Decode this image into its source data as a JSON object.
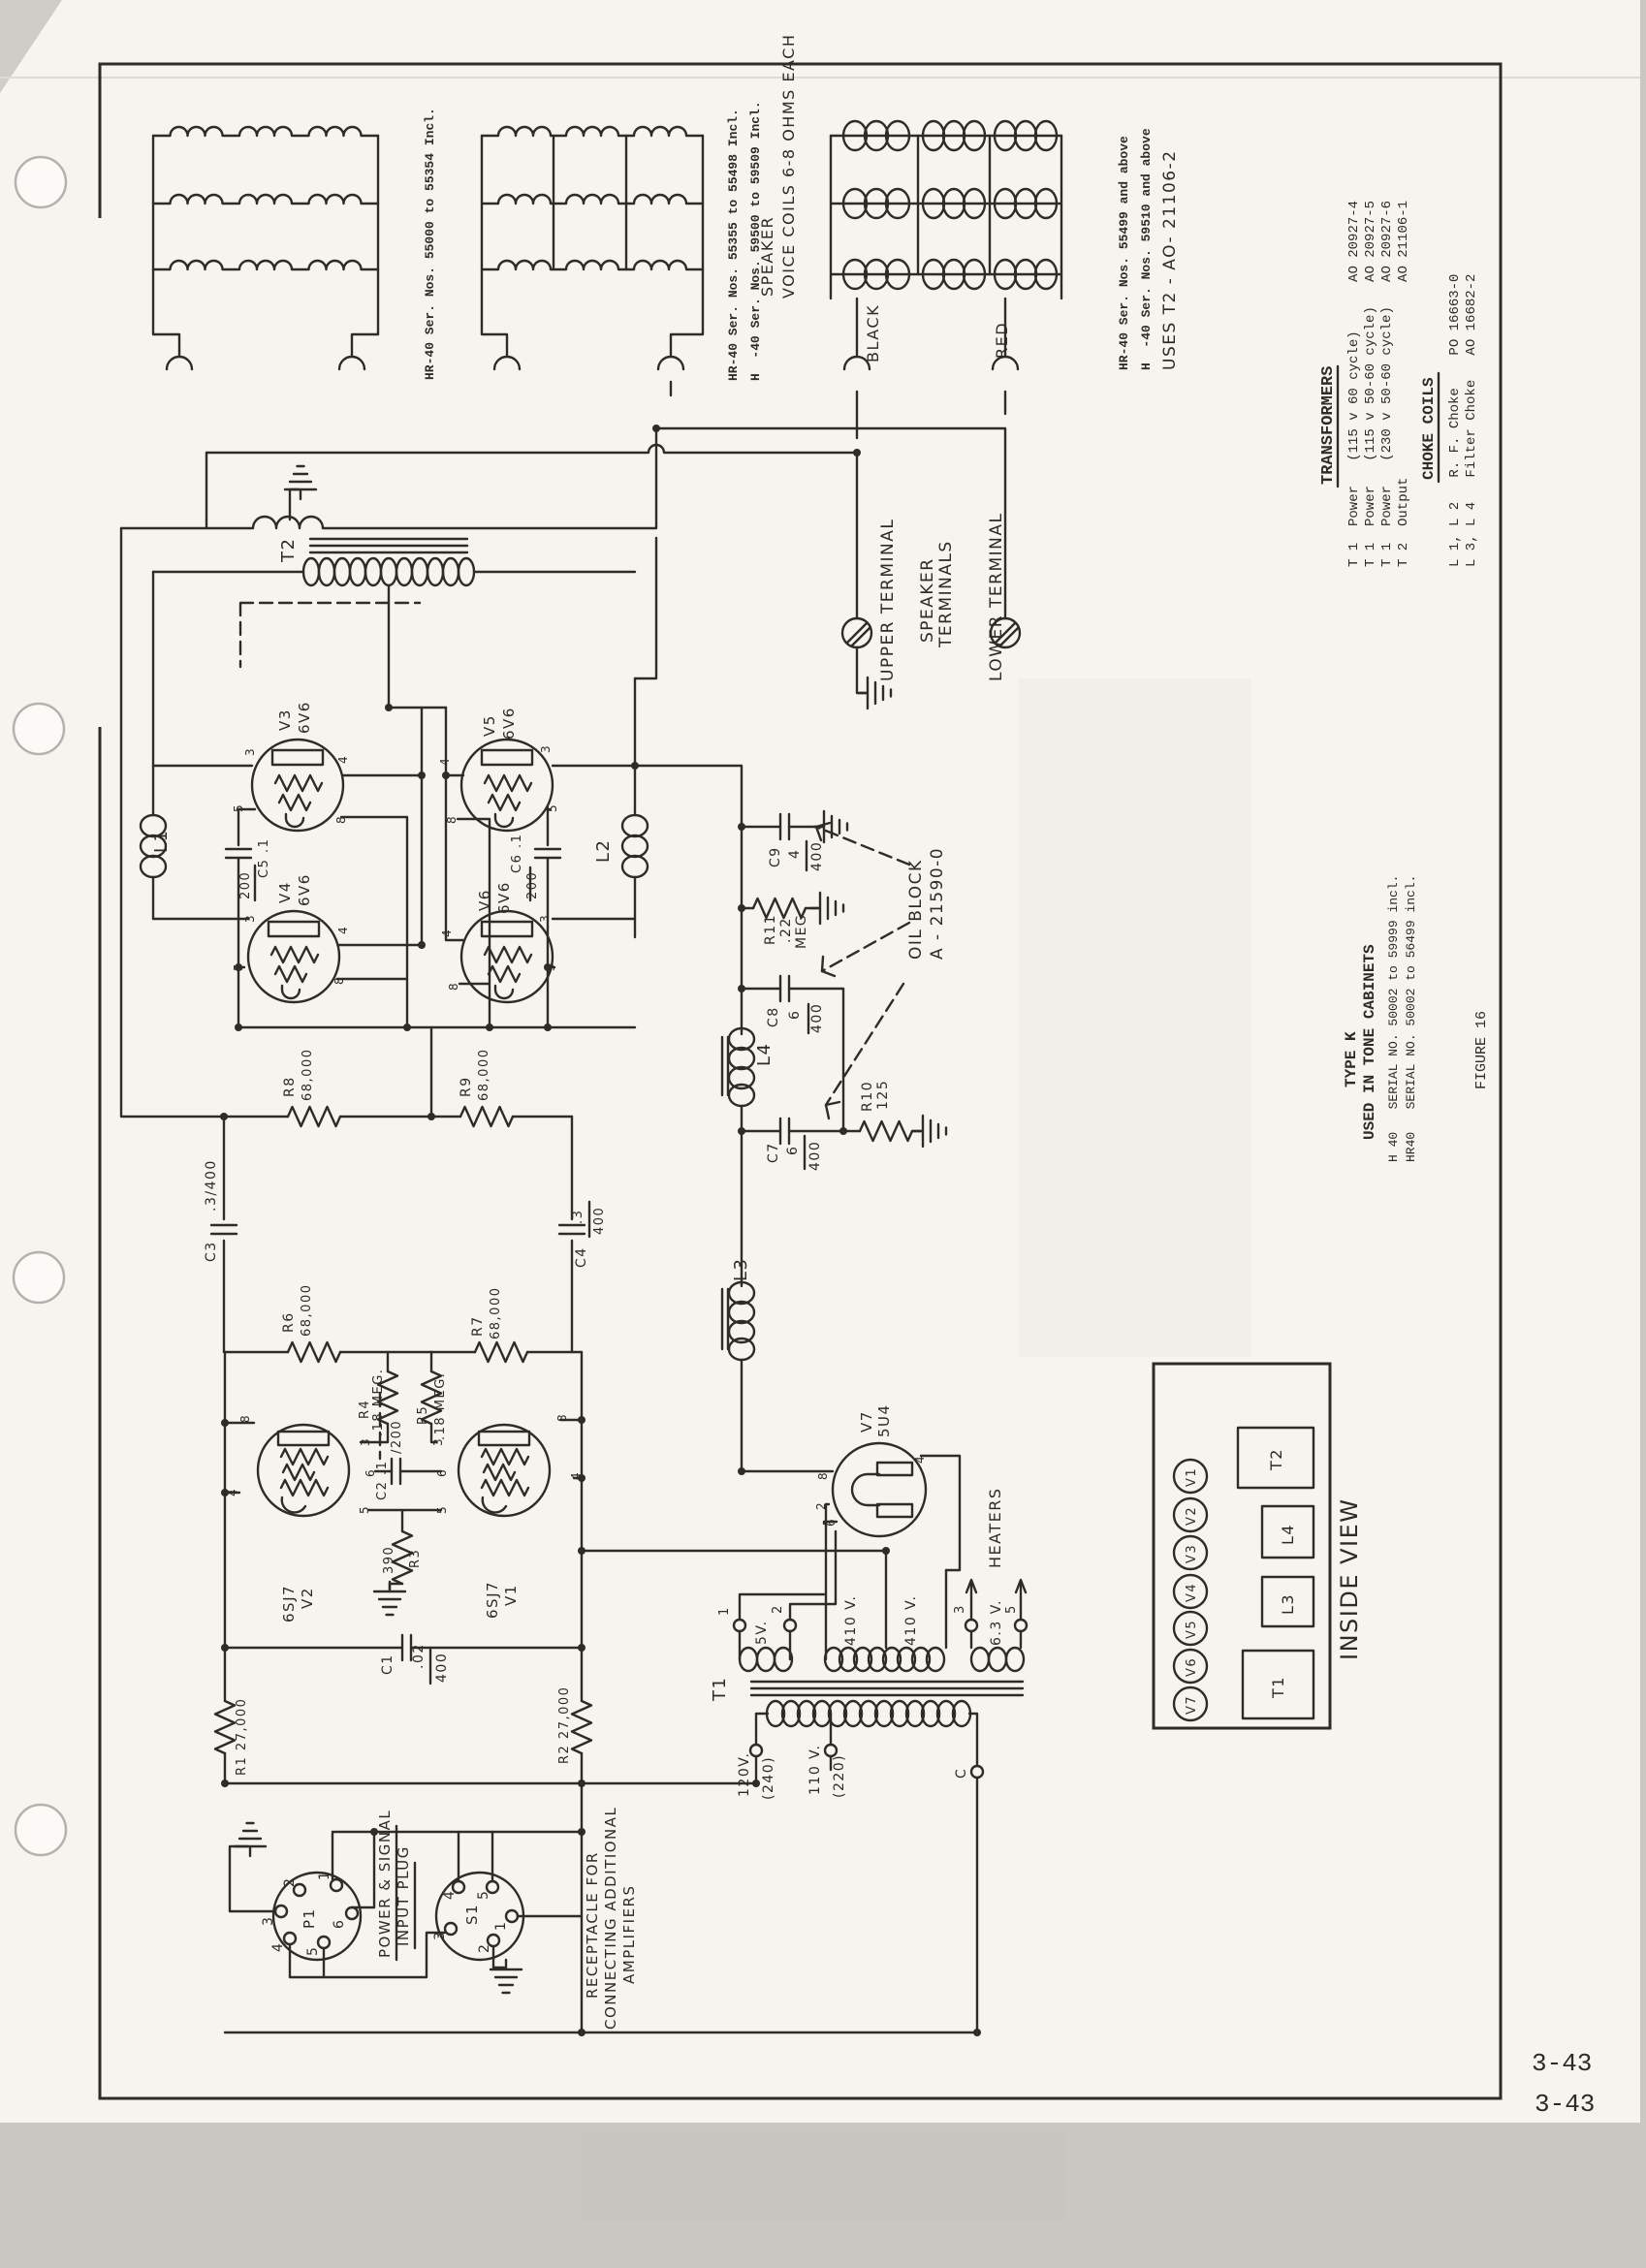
{
  "page": {
    "number": "3-43",
    "figure": "FIGURE 16"
  },
  "speaker_section": {
    "group1_caption": "HR-40 Ser. Nos. 55000 to 55354 Incl.",
    "group2_caption1": "HR-40 Ser. Nos. 55355 to 55498 Incl.",
    "group2_caption2": "H  -40 Ser. Nos. 59500 to 59509 Incl.",
    "speaker1": "SPEAKER",
    "speaker2": "VOICE COILS 6-8 OHMS EACH",
    "group3_caption1": "HR-40 Ser. Nos. 55499 and above",
    "group3_caption2": "H  -40 Ser. Nos. 59510 and above",
    "group3_caption3": "USES T2 - AO- 21106-2",
    "black": "BLACK",
    "red": "RED"
  },
  "terminals": {
    "upper": "UPPER TERMINAL",
    "spk1": "SPEAKER",
    "spk2": "TERMINALS",
    "lower": "LOWER TERMINAL"
  },
  "tables": {
    "transformers": {
      "title": "TRANSFORMERS",
      "rows": [
        "T 1  Power   (115 v 60 cycle)      AO 20927-4",
        "T 1  Power   (115 v 50-60 cycle)   AO 20927-5",
        "T 1  Power   (230 v 50-60 cycle)   AO 20927-6",
        "T 2  Output                        AO 21106-1"
      ]
    },
    "choke_coils": {
      "title": "CHOKE COILS",
      "rows": [
        "L 1, L 2   R. F. Choke    PO 16663-0",
        "L 3, L 4   Filter Choke   AO 16682-2"
      ]
    }
  },
  "type_block": {
    "line1": "TYPE K",
    "line2": "USED IN TONE CABINETS",
    "line3": "H 40   SERIAL NO. 50002 to 59999 incl.",
    "line4": "HR40   SERIAL NO. 50002 to 56499 incl."
  },
  "inside_view": {
    "title": "INSIDE VIEW",
    "tubes": [
      "V1",
      "V2",
      "V3",
      "V4",
      "V5",
      "V6",
      "V7"
    ],
    "blocks": [
      "T2",
      "L4",
      "L3",
      "T1"
    ]
  },
  "labels": {
    "t2": "T2",
    "t1": "T1",
    "l1": "L1",
    "l2": "L2",
    "l3": "L3",
    "l4": "L4",
    "v1": "V1",
    "v2": "V2",
    "v3": "V3",
    "v4": "V4",
    "v5": "V5",
    "v6": "V6",
    "v7": "V7",
    "type6v6": "6V6",
    "type6sj7": "6SJ7",
    "type5u4": "5U4",
    "r1": "R1 27,000",
    "r2": "R2 27,000",
    "r3": "R3",
    "r3v": "390",
    "r4": "R4",
    "r5": "R5",
    "meg18": ".18 MEG.",
    "r6": "R6",
    "r7": "R7",
    "r8": "R8",
    "r9": "R9",
    "k68": "68,000",
    "r10": "R10",
    "r10v": "125",
    "r11": "R11",
    "r11n": ".22",
    "r11d": "MEG.",
    "c1": "C1",
    "c1n": ".02",
    "c1d": "400",
    "c2": "C2 .1",
    "c2d": "/200",
    "c3": "C3",
    "c3v": ".3/400",
    "c4": "C4",
    "c4n": ".3",
    "c4d": "400",
    "c5": "C5 .1",
    "c5d": "200",
    "c6": "C6 .1",
    "c6d": "200",
    "c7": "C7",
    "c7n": "6",
    "c7d": "400",
    "c8": "C8",
    "c8n": "6",
    "c8d": "400",
    "c9": "C9",
    "c9n": "4",
    "c9d": "400",
    "oil1": "OIL BLOCK",
    "oil2": "A - 21590-0",
    "heaters": "HEATERS",
    "n1": "1",
    "n2": "2",
    "n3": "3",
    "n5": "5",
    "v5v": "5V.",
    "v410": "410 V.",
    "v63": "6.3 V.",
    "v120": "120V.",
    "v240": "(240)",
    "v110": "110 V.",
    "v220": "(220)",
    "tc": "C",
    "p1": "P1",
    "s1": "S1",
    "pow1": "POWER & SIGNAL",
    "pow2": "INPUT PLUG",
    "rec1": "RECEPTACLE FOR",
    "rec2": "CONNECTING ADDITIONAL",
    "rec3": "AMPLIFIERS"
  },
  "pins": {
    "1": "1",
    "2": "2",
    "3": "3",
    "4": "4",
    "5": "5",
    "6": "6",
    "8": "8"
  }
}
